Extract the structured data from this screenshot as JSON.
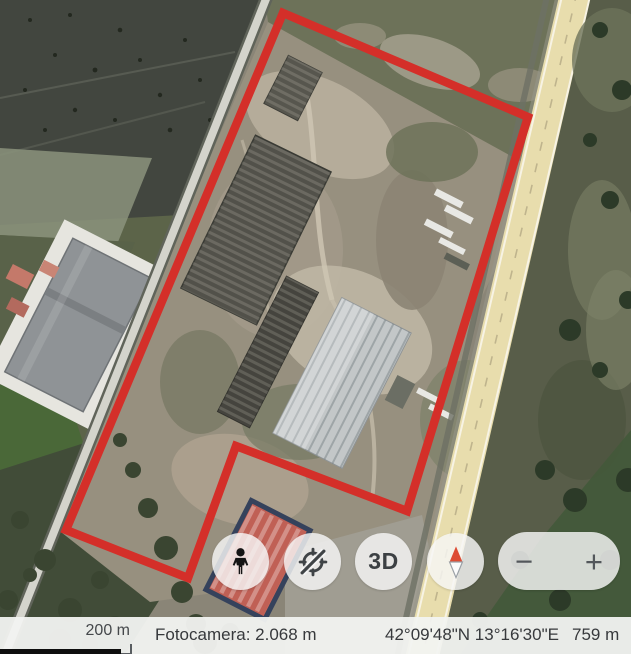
{
  "app_title": "Satellite map view",
  "boundary": {
    "color": "#d42f29",
    "points": "283,13 528,117 407,511 236,446 188,578 66,530"
  },
  "controls": {
    "pegman_icon": "pegman-icon",
    "rotation_icon": "rotation-disabled-icon",
    "view_3d_label": "3D",
    "compass_icon": "compass-north-icon",
    "zoom_out_label": "−",
    "zoom_in_label": "+"
  },
  "status_bar": {
    "scale_text": "200 m",
    "camera_text": "Fotocamera: 2.068 m",
    "coordinates_text": "42°09'48\"N 13°16'30\"E",
    "elevation_text": "759 m"
  },
  "map_colors": {
    "boundary_red": "#d42f29",
    "highway_tan": "#e8ddad",
    "dark_field": "#42463f",
    "wasteland": "#97907f"
  }
}
